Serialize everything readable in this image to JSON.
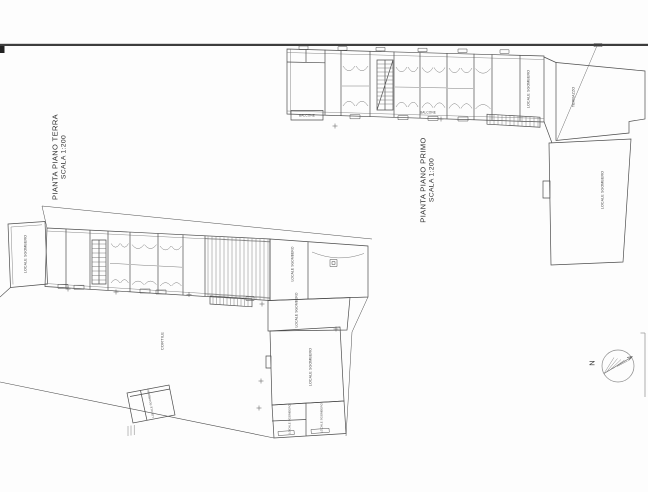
{
  "plans": {
    "ground_floor": {
      "title": "PIANTA PIANO TERRA",
      "scale": "SCALA 1:200"
    },
    "first_floor": {
      "title": "PIANTA PIANO PRIMO",
      "scale": "SCALA 1:200"
    }
  },
  "compass": {
    "label": "N"
  },
  "room_labels": [
    {
      "text": "BALCONE",
      "x": 307,
      "y": 116,
      "rot": 0,
      "size": 3.2
    },
    {
      "text": "BALCONE",
      "x": 428,
      "y": 112.5,
      "rot": 0,
      "size": 3.2
    },
    {
      "text": "LOCALE SGOMBERO",
      "x": 529,
      "y": 89,
      "rot": -90,
      "size": 3.6
    },
    {
      "text": "TERRAZZO",
      "x": 574,
      "y": 97,
      "rot": -90,
      "size": 3.6
    },
    {
      "text": "LOCALE SGOMBERO",
      "x": 603,
      "y": 190,
      "rot": -90,
      "size": 3.6
    },
    {
      "text": "LOCALE SGOMBERO",
      "x": 26,
      "y": 254,
      "rot": -90,
      "size": 3.6
    },
    {
      "text": "LOCALE SGOMBERO",
      "x": 293,
      "y": 264,
      "rot": -90,
      "size": 3.3
    },
    {
      "text": "LOCALE SGOMBERO",
      "x": 297,
      "y": 310,
      "rot": -90,
      "size": 3.3
    },
    {
      "text": "LOCALE SGOMBERO",
      "x": 311,
      "y": 367,
      "rot": -90,
      "size": 3.6
    },
    {
      "text": "LOCALE SGOMBERO",
      "x": 290,
      "y": 419,
      "rot": -90,
      "size": 2.8
    },
    {
      "text": "LOCALE SGOMBERO",
      "x": 322,
      "y": 418,
      "rot": -90,
      "size": 2.8
    },
    {
      "text": "CORTILE",
      "x": 163,
      "y": 341,
      "rot": -90,
      "size": 4
    },
    {
      "text": "LOCALE SGOMBERO",
      "x": 151,
      "y": 403,
      "rot": -100,
      "size": 2.8
    }
  ],
  "colors": {
    "line": "#4d4d4d",
    "fine": "#6e6e6e",
    "sheet_bar": "#3d3d3d"
  }
}
